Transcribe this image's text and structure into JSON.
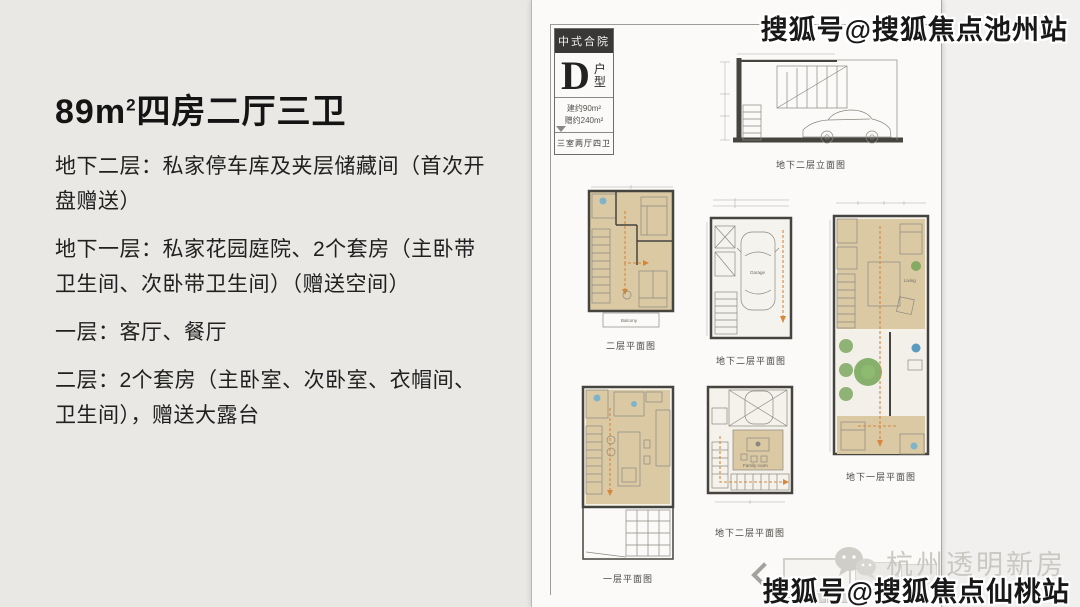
{
  "left_panel": {
    "title_prefix": "89m",
    "title_sup": "2",
    "title_suffix": "四房二厅三卫",
    "paragraphs": [
      "地下二层：私家停车库及夹层储藏间（首次开盘赠送）",
      "地下一层：私家花园庭院、2个套房（主卧带卫生间、次卧带卫生间）（赠送空间）",
      "一层：客厅、餐厅",
      "二层：2个套房（主卧室、次卧室、衣帽间、卫生间），赠送大露台"
    ]
  },
  "plan_card": {
    "label_box": {
      "badge": "中式合院",
      "letter": "D",
      "type_label": "户型",
      "area_line1": "建约90m²",
      "area_line2": "赠约240m²",
      "rooms_line": "三室两厅四卫"
    },
    "captions": {
      "elevation_b2": "地下二层立面图",
      "floor2": "二层平面图",
      "basement2": "地下二层平面图",
      "basement1": "地下一层平面图",
      "floor1": "一层平面图",
      "basement2_mezz": "地下二层平面图"
    },
    "room_labels": {
      "garage": "Garage",
      "living": "Living",
      "balcony": "Balcony",
      "family": "Family room",
      "master": "Master Bedroom"
    }
  },
  "watermarks": {
    "top_right": "搜狐号@搜狐焦点池州站",
    "bottom_brand": "杭州透明新房",
    "bottom_right": "搜狐号@搜狐焦点仙桃站"
  },
  "colors": {
    "accent_red": "#c0392b",
    "plan_beige": "#dbc9a4",
    "plan_orange": "#d6873c",
    "plan_green": "#76a457",
    "watermark_text": "#181818",
    "brand_gray": "#cac8c3"
  }
}
